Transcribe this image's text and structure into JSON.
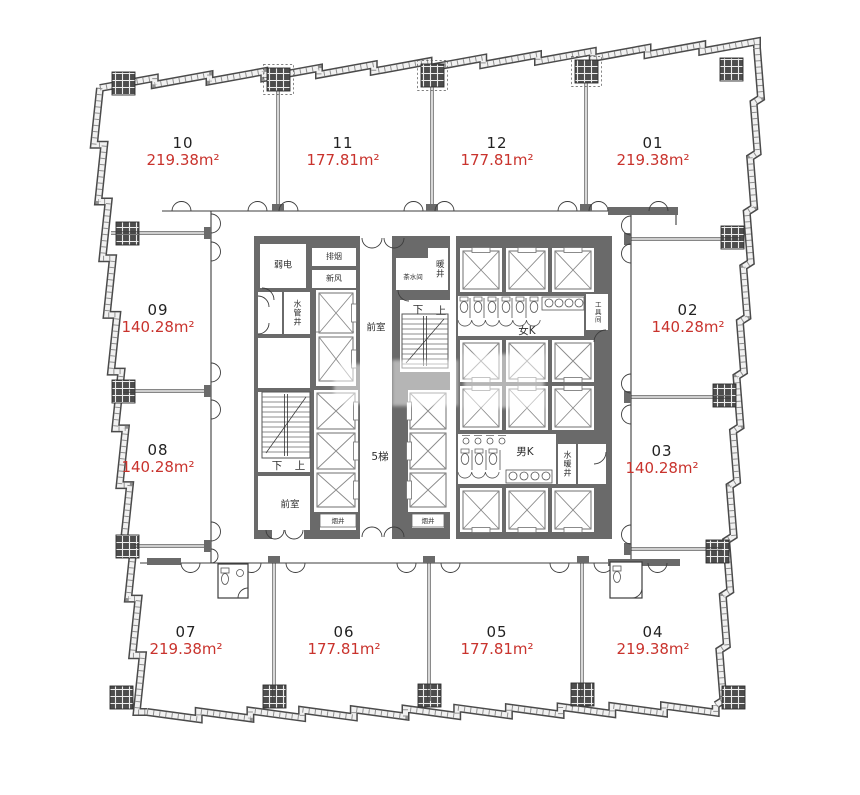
{
  "colors": {
    "area_text": "#c9332d",
    "unit_number_text": "#222222",
    "wall": "#6a6a6a"
  },
  "units": [
    {
      "number": "10",
      "area": "219.38m²"
    },
    {
      "number": "11",
      "area": "177.81m²"
    },
    {
      "number": "12",
      "area": "177.81m²"
    },
    {
      "number": "01",
      "area": "219.38m²"
    },
    {
      "number": "02",
      "area": "140.28m²"
    },
    {
      "number": "03",
      "area": "140.28m²"
    },
    {
      "number": "04",
      "area": "219.38m²"
    },
    {
      "number": "05",
      "area": "177.81m²"
    },
    {
      "number": "06",
      "area": "177.81m²"
    },
    {
      "number": "07",
      "area": "219.38m²"
    },
    {
      "number": "08",
      "area": "140.28m²"
    },
    {
      "number": "09",
      "area": "140.28m²"
    }
  ],
  "core_labels": {
    "weak_current": "弱电",
    "smoke_exhaust": "排烟",
    "fresh_air": "新风",
    "water_pipe_shaft": "水管井",
    "anteroom_upper": "前室",
    "anteroom_lower": "前室",
    "down_upper": "下",
    "up_upper": "上",
    "down_lower": "下",
    "up_lower": "上",
    "elevator_lobby": "5梯",
    "tea_room": "茶水间",
    "heating_shaft": "暖井",
    "womens_wc": "女K",
    "mens_wc": "男K",
    "water_heating_shaft": "水暖井",
    "tool_room": "工具间",
    "smoke_shaft_left": "烟井",
    "smoke_shaft_mid": "烟井"
  }
}
